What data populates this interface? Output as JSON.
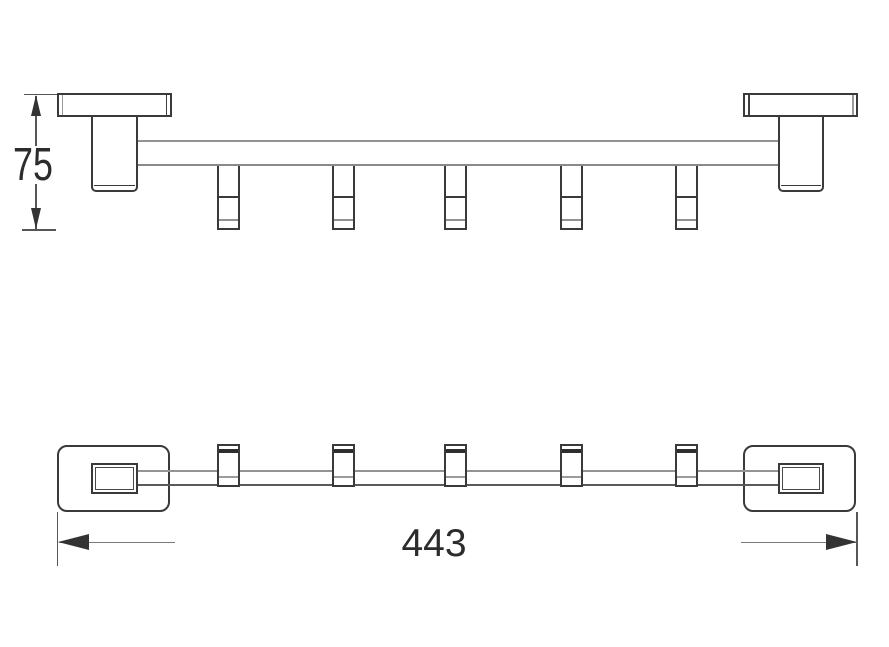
{
  "page": {
    "background": "#ffffff"
  },
  "drawing": {
    "type": "technical-dimension-drawing",
    "hook_count": 5,
    "dimension_height_label": "75",
    "dimension_length_label": "443",
    "colors": {
      "line_dark": "#3a3a3a",
      "line_gray": "#939393",
      "dimension_text": "#2c2c2c"
    }
  }
}
